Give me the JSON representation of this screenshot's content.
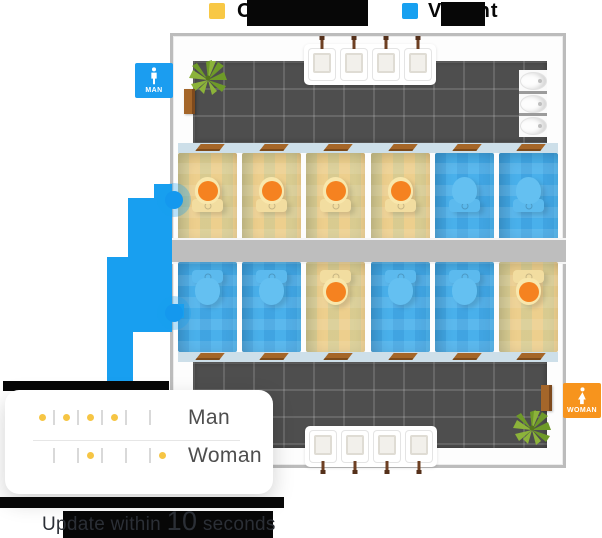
{
  "legend": {
    "occupied_label": "Occupied",
    "vacant_label": "Vacant",
    "occupied_color": "#F8C845",
    "vacant_color": "#18A0F0"
  },
  "floorplan": {
    "man_badge_label": "MAN",
    "woman_badge_label": "WOMAN",
    "man_badge_color": "#1B9DF0",
    "woman_badge_color": "#F7941D",
    "man_stalls": [
      "occupied",
      "occupied",
      "occupied",
      "occupied",
      "vacant",
      "vacant"
    ],
    "woman_stalls": [
      "vacant",
      "vacant",
      "occupied",
      "vacant",
      "vacant",
      "occupied"
    ],
    "man_sink_count": 4,
    "woman_sink_count": 4,
    "urinal_count": 3,
    "occupied_stall_color": "#EDCF8D",
    "vacant_stall_color": "#49B0EB",
    "occupant_indicator_color": "#F58220",
    "entrance_path_color": "#189FF0"
  },
  "status_card": {
    "man_label": "Man",
    "woman_label": "Woman",
    "man_occupancy": [
      1,
      1,
      1,
      1,
      0,
      0
    ],
    "woman_occupancy": [
      0,
      0,
      1,
      0,
      0,
      1
    ],
    "dot_color": "#F6C544"
  },
  "footer": {
    "prefix": "Update within",
    "value": "10",
    "suffix": "seconds"
  }
}
